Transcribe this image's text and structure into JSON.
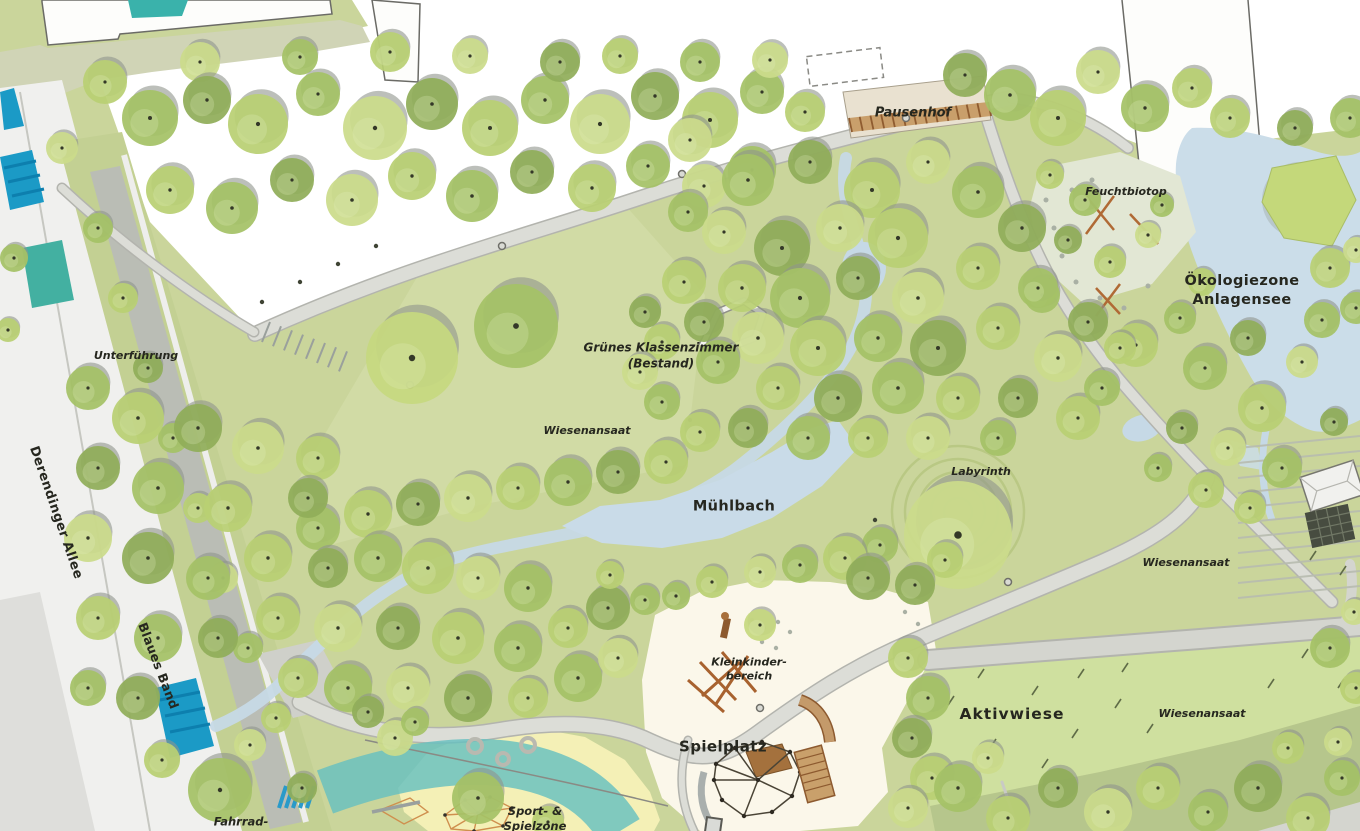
{
  "map": {
    "labels": {
      "pausenhof": "Pausenhof",
      "feuchtbiotop": "Feuchtbiotop",
      "oekologiezone": {
        "line1": "Ökologiezone",
        "line2": "Anlagensee"
      },
      "unterfuehrung": "Unterführung",
      "derendinger_allee": "Derendinger Allee",
      "gruenes_klassenzimmer": {
        "line1": "Grünes Klassenzimmer",
        "line2": "(Bestand)"
      },
      "wiesenansaat_zentral": "Wiesenansaat",
      "muehlbach": "Mühlbach",
      "labyrinth": "Labyrinth",
      "wiesenansaat_ost": "Wiesenansaat",
      "blaues_band": "Blaues Band",
      "kleinkinderbereich": {
        "line1": "Kleinkinder-",
        "line2": "bereich"
      },
      "spielplatz": "Spielplatz",
      "aktivwiese": "Aktivwiese",
      "wiesenansaat_suedost": "Wiesenansaat",
      "sport_spielzone": {
        "line1": "Sport- &",
        "line2": "Spielzone"
      },
      "fahrrad": "Fahrrad-"
    },
    "colors": {
      "meadow_base": "#cad59b",
      "meadow_light": "#cfe09f",
      "meadow_dark": "#b6c68c",
      "tree_light": "#b9d073",
      "tree_mid": "#a5c266",
      "tree_pale": "#cbdb8b",
      "tree_olive": "#90ad59",
      "tree_shadow": "#8f948c",
      "water_stream": "#c6d9e6",
      "water_lake": "#cbdde9",
      "water_canal": "#1b9ac6",
      "water_teal": "#43b0a1",
      "path_grey": "#dcddd7",
      "sand": "#fbf7ea",
      "sport_yellow": "#f4f0b6",
      "equipment_brown": "#a8622f"
    }
  }
}
